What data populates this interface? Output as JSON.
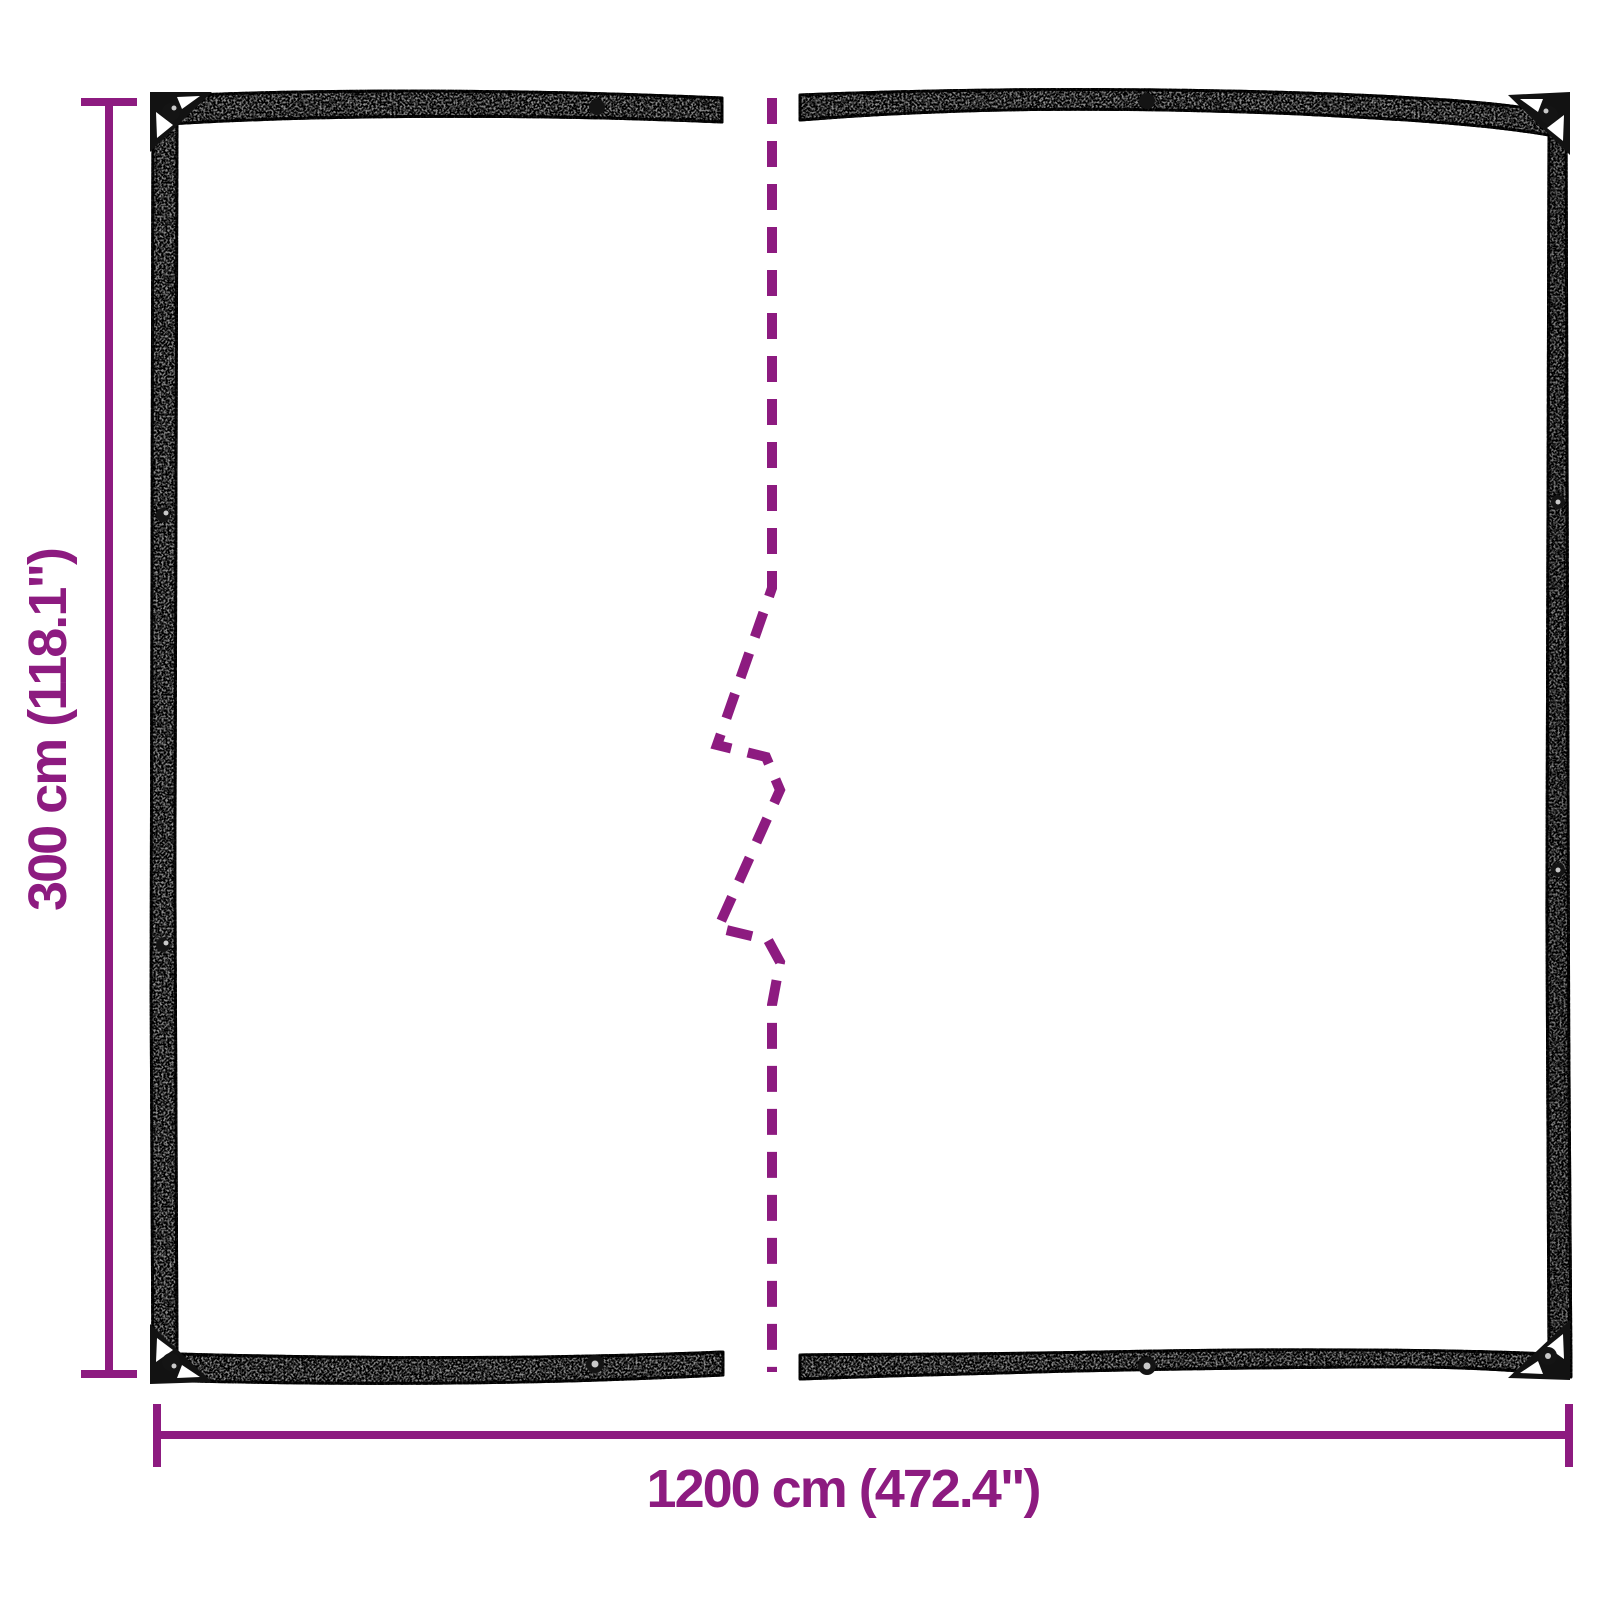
{
  "diagram": {
    "type": "product-dimension-diagram",
    "subject": "tarpaulin with eyelets, shown split with a break line (full length not drawn)",
    "height_dimension": {
      "label": "300 cm (118.1\")",
      "value_cm": 300,
      "value_inch": 118.1,
      "orientation": "vertical-left"
    },
    "width_dimension": {
      "label": "1200 cm (472.4\")",
      "value_cm": 1200,
      "value_inch": 472.4,
      "orientation": "horizontal-bottom"
    }
  },
  "colors": {
    "background": "#ffffff",
    "dimension": "#8D1B80",
    "tarp_edge_fill": "#909090",
    "tarp_edge_fill_smooth": "#7f7f7f",
    "tarp_outline": "#1d1d1d",
    "corner_fill": "#121212",
    "grommet_dark": "#141414",
    "grommet_light": "#c9c9c9"
  }
}
